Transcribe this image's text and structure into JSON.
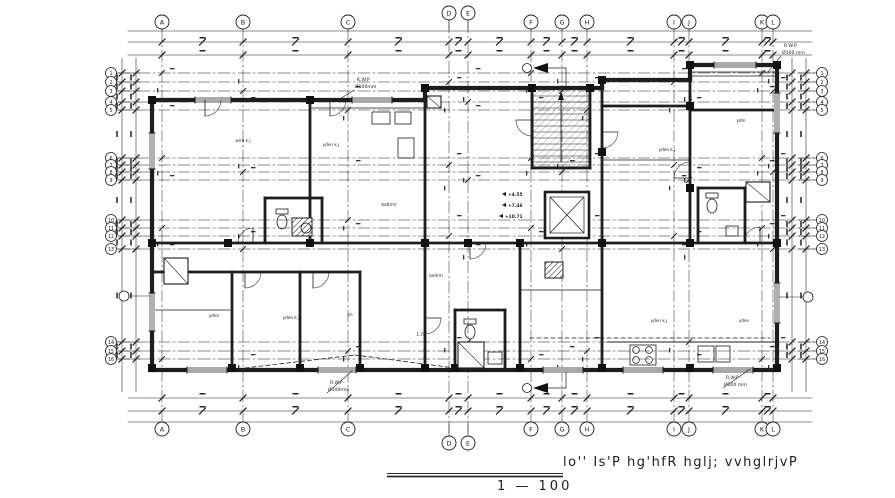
{
  "drawing": {
    "title": "lo''  Is'P  hg'hfR  hglj; vvhglrjvP",
    "scale_text": "1   —   100"
  },
  "grid": {
    "columns": [
      [
        "A",
        162
      ],
      [
        "B",
        243
      ],
      [
        "C",
        348
      ],
      [
        "D",
        449
      ],
      [
        "E",
        468
      ],
      [
        "F",
        531
      ],
      [
        "G",
        562
      ],
      [
        "H",
        587
      ],
      [
        "I",
        674
      ],
      [
        "J",
        689
      ],
      [
        "K",
        762
      ],
      [
        "L",
        773
      ]
    ],
    "rows": [
      [
        "1",
        73
      ],
      [
        "2",
        82
      ],
      [
        "3",
        91
      ],
      [
        "4",
        102
      ],
      [
        "5",
        110
      ],
      [
        "6",
        158
      ],
      [
        "7",
        165
      ],
      [
        "8",
        172
      ],
      [
        "9",
        180
      ],
      [
        "10",
        220
      ],
      [
        "11",
        228
      ],
      [
        "12",
        236
      ],
      [
        "13",
        249
      ],
      [
        "14",
        342
      ],
      [
        "15",
        351
      ],
      [
        "16",
        359
      ]
    ]
  },
  "pipe_labels": [
    {
      "name": "K.W.P",
      "size": "Ø100mm",
      "x": 357,
      "y": 81,
      "lx": 340,
      "ly": 99
    },
    {
      "name": "R.W.P",
      "size": "Ø100 mm",
      "x": 784,
      "y": 47,
      "lx": 768,
      "ly": 72
    },
    {
      "name": "R.W.P",
      "size": "Ø100mm",
      "x": 330,
      "y": 384,
      "lx": 352,
      "ly": 371
    },
    {
      "name": "R.W.P",
      "size": "Ø100 mm",
      "x": 726,
      "y": 379,
      "lx": 750,
      "ly": 369
    }
  ],
  "levels": [
    {
      "text": "+4.55",
      "x": 508,
      "y": 196
    },
    {
      "text": "+7.46",
      "x": 508,
      "y": 207
    },
    {
      "text": "+10.71",
      "x": 505,
      "y": 218
    }
  ],
  "rooms": [
    {
      "label": "w/m k.j",
      "x": 243,
      "y": 142
    },
    {
      "label": "yden k.j",
      "x": 331,
      "y": 146
    },
    {
      "label": "yden k.j",
      "x": 667,
      "y": 151
    },
    {
      "label": "ydm",
      "x": 741,
      "y": 122
    },
    {
      "label": "bathrm",
      "x": 389,
      "y": 206
    },
    {
      "label": "yden",
      "x": 214,
      "y": 317
    },
    {
      "label": "yden k.j",
      "x": 291,
      "y": 319
    },
    {
      "label": "jm",
      "x": 350,
      "y": 316
    },
    {
      "label": "bedrm",
      "x": 436,
      "y": 277
    },
    {
      "label": "1.78",
      "x": 421,
      "y": 336
    },
    {
      "label": "yden k.j",
      "x": 659,
      "y": 322
    },
    {
      "label": "yden",
      "x": 744,
      "y": 322
    }
  ],
  "section_markers": [
    {
      "x": 527,
      "y": 68
    },
    {
      "x": 527,
      "y": 388
    }
  ]
}
